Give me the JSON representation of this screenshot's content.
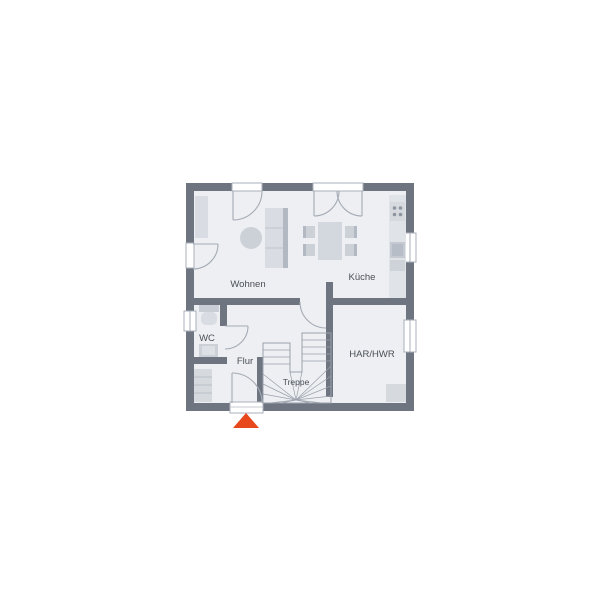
{
  "plan": {
    "title": "Erdgeschoss Grundriss",
    "rooms": {
      "wohnen": {
        "label": "Wohnen"
      },
      "kueche": {
        "label": "Küche"
      },
      "wc": {
        "label": "WC"
      },
      "flur": {
        "label": "Flur"
      },
      "treppe": {
        "label": "Treppe"
      },
      "har_hwr": {
        "label": "HAR/HWR"
      }
    },
    "entrance": {
      "marker": "triangle-up-arrow",
      "color": "#e8491c"
    },
    "palette": {
      "wall": "#6e7581",
      "floor": "#edeff2",
      "furniture_light": "#d9dce2",
      "furniture_mid": "#ccd1d8",
      "furniture_dark": "#b3b9c3",
      "door_line": "#a5abb5",
      "label_text": "#4a4f57"
    }
  }
}
